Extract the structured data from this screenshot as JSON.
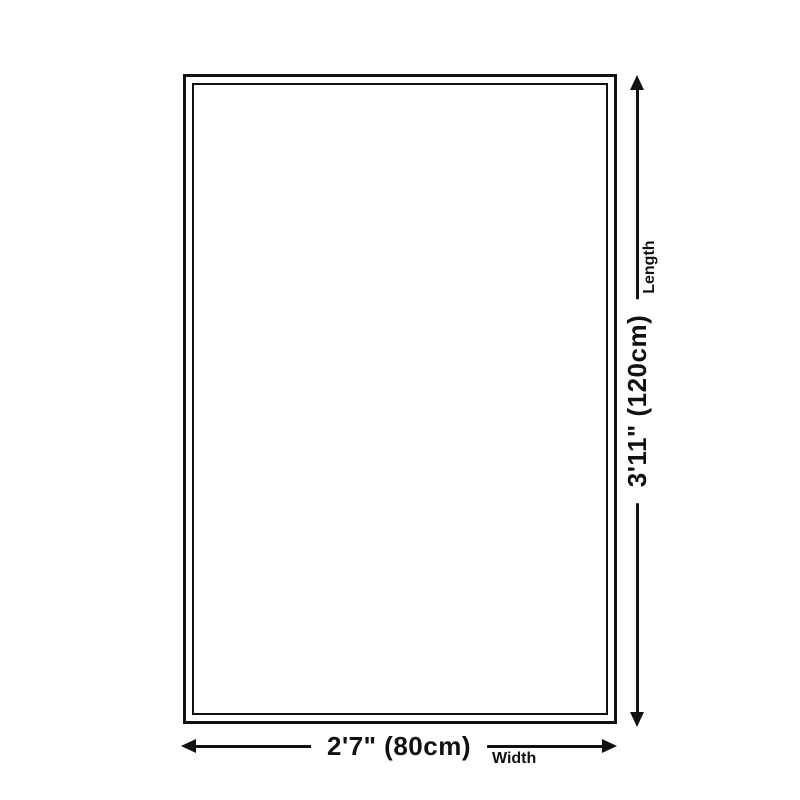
{
  "page": {
    "background_color": "#ffffff",
    "line_color": "#111111"
  },
  "diagram": {
    "type": "product-size-diagram",
    "rug": {
      "fill": "#ffffff",
      "border_style": "double"
    },
    "length_dimension": {
      "value": "3'11\" (120cm)",
      "axis_label": "Length",
      "orientation": "vertical"
    },
    "width_dimension": {
      "value": "2'7\" (80cm)",
      "axis_label": "Width",
      "orientation": "horizontal"
    }
  }
}
